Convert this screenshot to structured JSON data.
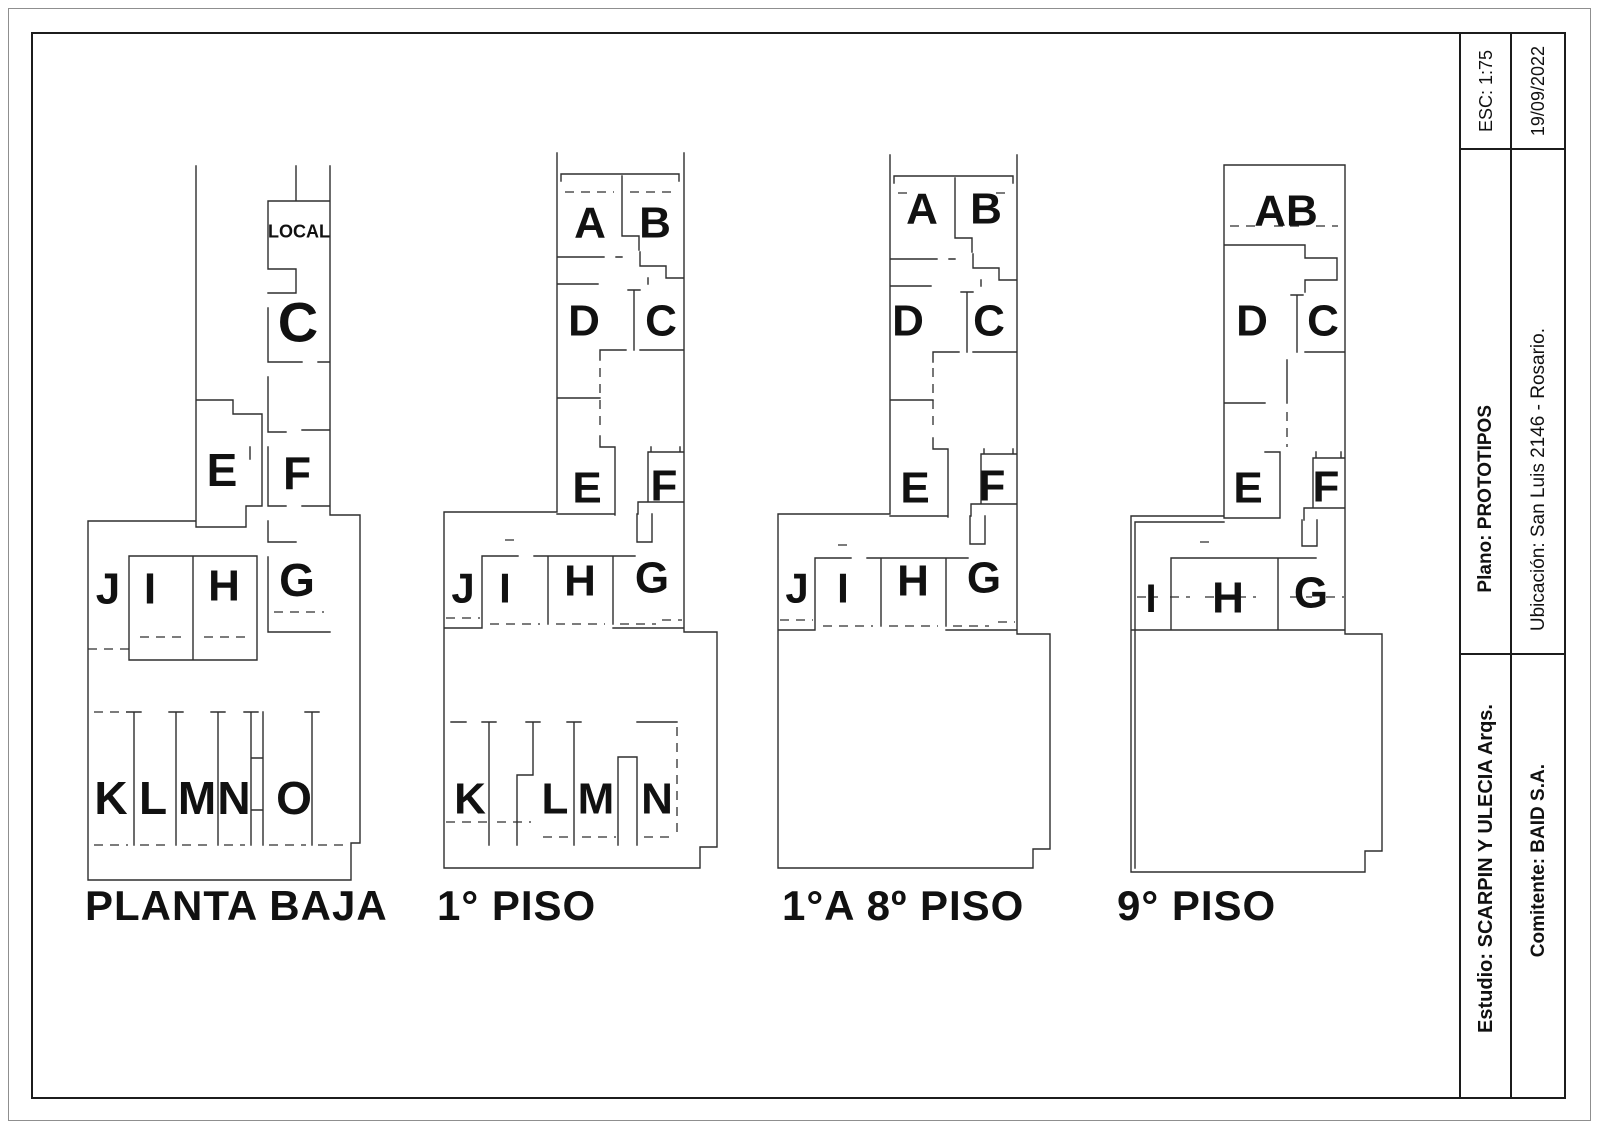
{
  "sheet": {
    "colors": {
      "wall": "#2e2e2e",
      "text": "#111111",
      "border": "#1c1c1c",
      "outer_border": "#8f8f8f",
      "background": "#ffffff"
    },
    "title_block": {
      "esc": "ESC: 1:75",
      "fecha": "19/09/2022",
      "plano": "Plano:  PROTOTIPOS",
      "ubicacion": "Ubicación: San Luis 2146  - Rosario.",
      "estudio": "Estudio: SCARPIN Y ULECIA Arqs.",
      "comitente": "Comitente: BAID S.A."
    },
    "plans": [
      {
        "id": "planta-baja",
        "title": "PLANTA BAJA",
        "title_x": 85,
        "title_y": 920,
        "title_size": 42,
        "labels": [
          {
            "t": "LOCAL",
            "x": 299,
            "y": 231,
            "s": 18
          },
          {
            "t": "C",
            "x": 298,
            "y": 322,
            "s": 56
          },
          {
            "t": "E",
            "x": 222,
            "y": 470,
            "s": 46
          },
          {
            "t": "F",
            "x": 297,
            "y": 473,
            "s": 46
          },
          {
            "t": "J",
            "x": 108,
            "y": 588,
            "s": 44
          },
          {
            "t": "I",
            "x": 150,
            "y": 588,
            "s": 44
          },
          {
            "t": "H",
            "x": 224,
            "y": 585,
            "s": 44
          },
          {
            "t": "G",
            "x": 297,
            "y": 580,
            "s": 46
          },
          {
            "t": "K",
            "x": 111,
            "y": 798,
            "s": 46
          },
          {
            "t": "L",
            "x": 153,
            "y": 798,
            "s": 46
          },
          {
            "t": "M",
            "x": 197,
            "y": 798,
            "s": 46
          },
          {
            "t": "N",
            "x": 234,
            "y": 798,
            "s": 46
          },
          {
            "t": "O",
            "x": 294,
            "y": 798,
            "s": 46
          }
        ]
      },
      {
        "id": "piso-1",
        "title": "1°  PISO",
        "title_x": 437,
        "title_y": 920,
        "title_size": 42,
        "labels": [
          {
            "t": "A",
            "x": 590,
            "y": 222,
            "s": 44
          },
          {
            "t": "B",
            "x": 655,
            "y": 222,
            "s": 44
          },
          {
            "t": "D",
            "x": 584,
            "y": 320,
            "s": 44
          },
          {
            "t": "C",
            "x": 661,
            "y": 320,
            "s": 44
          },
          {
            "t": "E",
            "x": 587,
            "y": 487,
            "s": 44
          },
          {
            "t": "F",
            "x": 664,
            "y": 485,
            "s": 44
          },
          {
            "t": "J",
            "x": 463,
            "y": 588,
            "s": 42
          },
          {
            "t": "I",
            "x": 505,
            "y": 588,
            "s": 42
          },
          {
            "t": "H",
            "x": 580,
            "y": 580,
            "s": 44
          },
          {
            "t": "G",
            "x": 652,
            "y": 577,
            "s": 44
          },
          {
            "t": "K",
            "x": 470,
            "y": 798,
            "s": 44
          },
          {
            "t": "L",
            "x": 555,
            "y": 798,
            "s": 44
          },
          {
            "t": "M",
            "x": 596,
            "y": 798,
            "s": 44
          },
          {
            "t": "N",
            "x": 657,
            "y": 798,
            "s": 44
          }
        ]
      },
      {
        "id": "piso-1a8",
        "title": "1°A 8º PISO",
        "title_x": 782,
        "title_y": 920,
        "title_size": 42,
        "labels": [
          {
            "t": "A",
            "x": 922,
            "y": 208,
            "s": 44
          },
          {
            "t": "B",
            "x": 986,
            "y": 208,
            "s": 44
          },
          {
            "t": "D",
            "x": 908,
            "y": 320,
            "s": 44
          },
          {
            "t": "C",
            "x": 989,
            "y": 320,
            "s": 44
          },
          {
            "t": "E",
            "x": 915,
            "y": 487,
            "s": 44
          },
          {
            "t": "F",
            "x": 992,
            "y": 485,
            "s": 44
          },
          {
            "t": "J",
            "x": 797,
            "y": 588,
            "s": 42
          },
          {
            "t": "I",
            "x": 843,
            "y": 588,
            "s": 42
          },
          {
            "t": "H",
            "x": 913,
            "y": 580,
            "s": 44
          },
          {
            "t": "G",
            "x": 984,
            "y": 577,
            "s": 44
          }
        ]
      },
      {
        "id": "piso-9",
        "title": "9° PISO",
        "title_x": 1117,
        "title_y": 920,
        "title_size": 42,
        "labels": [
          {
            "t": "AB",
            "x": 1286,
            "y": 210,
            "s": 44
          },
          {
            "t": "D",
            "x": 1252,
            "y": 320,
            "s": 44
          },
          {
            "t": "C",
            "x": 1323,
            "y": 320,
            "s": 44
          },
          {
            "t": "E",
            "x": 1248,
            "y": 487,
            "s": 44
          },
          {
            "t": "F",
            "x": 1326,
            "y": 486,
            "s": 44
          },
          {
            "t": "I",
            "x": 1151,
            "y": 598,
            "s": 40
          },
          {
            "t": "H",
            "x": 1228,
            "y": 597,
            "s": 44
          },
          {
            "t": "G",
            "x": 1311,
            "y": 592,
            "s": 44
          }
        ]
      }
    ]
  }
}
